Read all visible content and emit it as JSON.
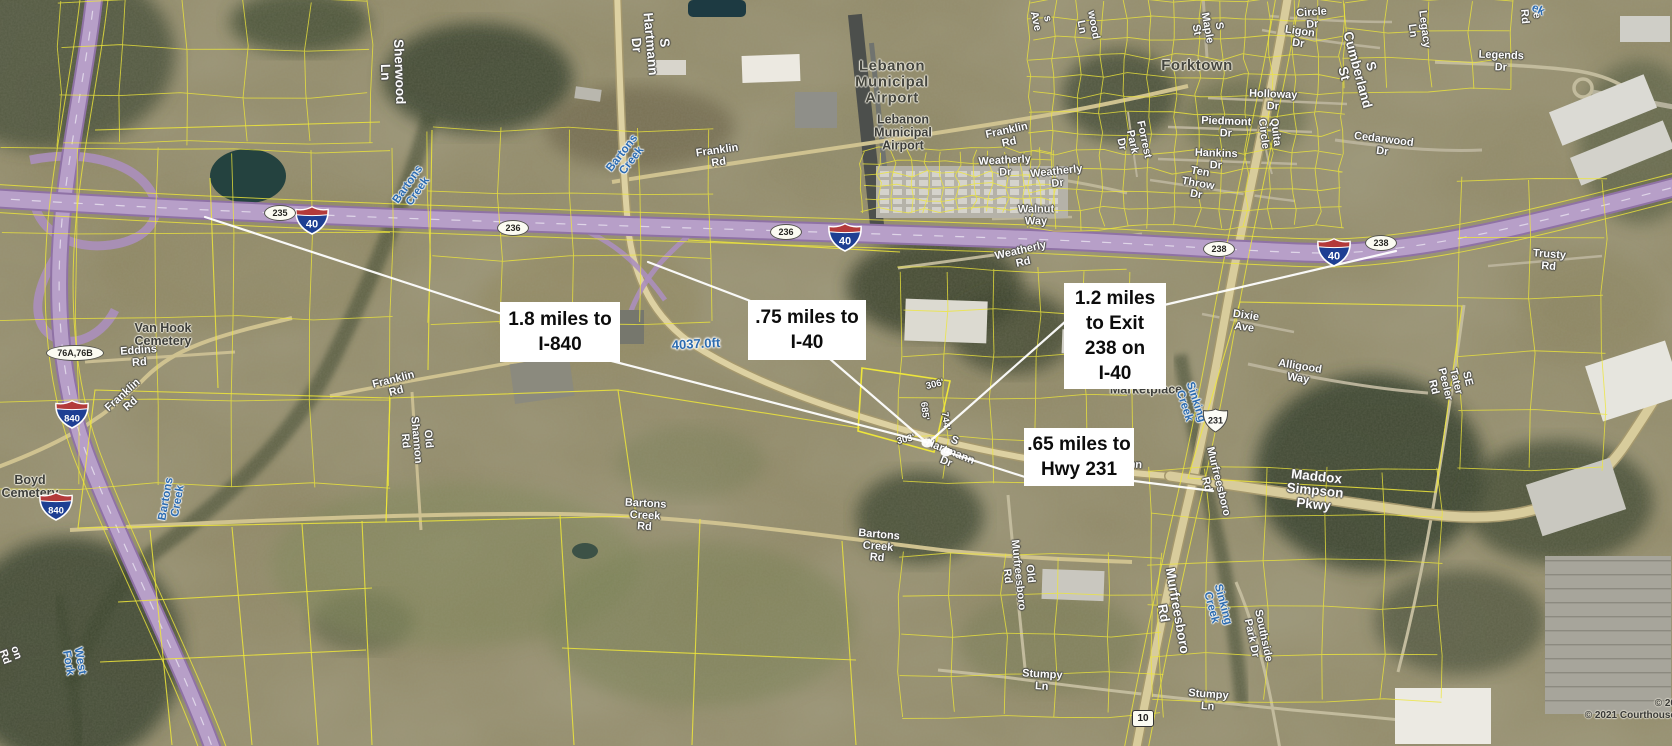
{
  "map": {
    "attribution": {
      "line1": "© 20",
      "line2": "© 2021 Courthouse"
    },
    "colors": {
      "parcel_line": "#eee63a",
      "interstate_fill": "#b79fc8",
      "road_fill": "#ddd1a2",
      "callout_bg": "#ffffff",
      "callout_text": "#0c0c0c",
      "creek_text": "#2d6cb0",
      "road_label_text": "#fdfdfd"
    },
    "callouts": [
      {
        "id": "c1",
        "lines": [
          "1.8 miles to",
          "I-840"
        ],
        "x": 500,
        "y": 302,
        "w": 120,
        "h": 60
      },
      {
        "id": "c2",
        "lines": [
          ".75 miles to",
          "I-40"
        ],
        "x": 748,
        "y": 300,
        "w": 118,
        "h": 60
      },
      {
        "id": "c3",
        "lines": [
          "1.2 miles",
          "to Exit",
          "238 on",
          "I-40"
        ],
        "x": 1064,
        "y": 283,
        "w": 102,
        "h": 106
      },
      {
        "id": "c4",
        "lines": [
          ".65 miles to",
          "Hwy 231"
        ],
        "x": 1024,
        "y": 428,
        "w": 110,
        "h": 58
      }
    ],
    "shields": [
      {
        "type": "i",
        "t": "40",
        "x": 312,
        "y": 220
      },
      {
        "type": "i",
        "t": "40",
        "x": 845,
        "y": 237
      },
      {
        "type": "i",
        "t": "40",
        "x": 1334,
        "y": 252
      },
      {
        "type": "i",
        "t": "840",
        "x": 72,
        "y": 414
      },
      {
        "type": "i",
        "t": "840",
        "x": 56,
        "y": 506
      },
      {
        "type": "mile",
        "t": "235",
        "x": 279,
        "y": 212
      },
      {
        "type": "mile",
        "t": "236",
        "x": 512,
        "y": 227
      },
      {
        "type": "mile",
        "t": "236",
        "x": 785,
        "y": 231
      },
      {
        "type": "mile",
        "t": "238",
        "x": 1218,
        "y": 248
      },
      {
        "type": "mile",
        "t": "238",
        "x": 1380,
        "y": 242
      },
      {
        "type": "exit",
        "t": "76A,76B",
        "x": 74,
        "y": 352
      },
      {
        "type": "us",
        "t": "231",
        "x": 1215,
        "y": 420
      },
      {
        "type": "sr",
        "t": "10",
        "x": 1142,
        "y": 718
      }
    ],
    "labels": [
      {
        "t": "Sherwood Ln",
        "x": 392,
        "y": 72,
        "r": 88,
        "c": "roadlg"
      },
      {
        "t": "S Hartmann Dr",
        "x": 650,
        "y": 44,
        "r": 85,
        "c": "roadlg"
      },
      {
        "t": "Franklin Rd",
        "x": 718,
        "y": 157,
        "r": -8,
        "c": "road"
      },
      {
        "t": "Lebanon Municipal Airport",
        "x": 892,
        "y": 82,
        "r": 0,
        "c": "placelg"
      },
      {
        "t": "Lebanon\nMunicipal\nAirport",
        "x": 903,
        "y": 133,
        "r": 0,
        "c": "place"
      },
      {
        "t": "Franklin Rd",
        "x": 1008,
        "y": 137,
        "r": -12,
        "c": "road"
      },
      {
        "t": "Weatherly Dr",
        "x": 1005,
        "y": 167,
        "r": -3,
        "c": "road"
      },
      {
        "t": "Weatherly Dr",
        "x": 1057,
        "y": 178,
        "r": -6,
        "c": "road"
      },
      {
        "t": "Walnut Way",
        "x": 1036,
        "y": 216,
        "r": 0,
        "c": "road"
      },
      {
        "t": "Weatherly Rd",
        "x": 1022,
        "y": 257,
        "r": -13,
        "c": "road"
      },
      {
        "t": "Forktown",
        "x": 1197,
        "y": 66,
        "r": 0,
        "c": "placelg"
      },
      {
        "t": "S Maple St",
        "x": 1207,
        "y": 28,
        "r": 80,
        "c": "road"
      },
      {
        "t": "s Ave",
        "x": 1041,
        "y": 20,
        "r": 78,
        "c": "road"
      },
      {
        "t": "wood Ln",
        "x": 1087,
        "y": 26,
        "r": 80,
        "c": "road"
      },
      {
        "t": "Circle Dr",
        "x": 1312,
        "y": 19,
        "r": -4,
        "c": "road"
      },
      {
        "t": "Ligon Dr",
        "x": 1299,
        "y": 38,
        "r": 8,
        "c": "road"
      },
      {
        "t": "Holloway Dr",
        "x": 1273,
        "y": 101,
        "r": 2,
        "c": "road"
      },
      {
        "t": "Piedmont Dr",
        "x": 1226,
        "y": 128,
        "r": 2,
        "c": "road"
      },
      {
        "t": "Quita Circle",
        "x": 1269,
        "y": 133,
        "r": 83,
        "c": "road"
      },
      {
        "t": "Hankins Dr",
        "x": 1216,
        "y": 160,
        "r": 2,
        "c": "road"
      },
      {
        "t": "Forrest Park Dr",
        "x": 1132,
        "y": 142,
        "r": 78,
        "c": "road"
      },
      {
        "t": "Ten Throw Dr",
        "x": 1198,
        "y": 184,
        "r": 10,
        "c": "road"
      },
      {
        "t": "S Cumberland St",
        "x": 1357,
        "y": 70,
        "r": 75,
        "c": "roadlg"
      },
      {
        "t": "Legacy Ln",
        "x": 1418,
        "y": 30,
        "r": 83,
        "c": "road"
      },
      {
        "t": "Legends Dr",
        "x": 1501,
        "y": 62,
        "r": 2,
        "c": "road"
      },
      {
        "t": "Cedarwood Dr",
        "x": 1383,
        "y": 146,
        "r": 7,
        "c": "road"
      },
      {
        "t": "e Rd",
        "x": 1530,
        "y": 16,
        "r": 85,
        "c": "road"
      },
      {
        "t": "ek",
        "x": 1538,
        "y": 10,
        "r": 25,
        "c": "creek"
      },
      {
        "t": "Trusty Rd",
        "x": 1549,
        "y": 261,
        "r": 4,
        "c": "road"
      },
      {
        "t": "SE Tater Peeler Rd",
        "x": 1450,
        "y": 383,
        "r": 76,
        "c": "road"
      },
      {
        "t": "Dixie Ave",
        "x": 1245,
        "y": 322,
        "r": 8,
        "c": "road"
      },
      {
        "t": "Alligood Way",
        "x": 1299,
        "y": 373,
        "r": 9,
        "c": "road"
      },
      {
        "t": "Marketplace",
        "x": 1146,
        "y": 390,
        "r": 0,
        "c": "place"
      },
      {
        "t": "Sinking Creek",
        "x": 1190,
        "y": 404,
        "r": 72,
        "c": "creek"
      },
      {
        "t": "Maddox Simpson Pkwy",
        "x": 1315,
        "y": 491,
        "r": 6,
        "c": "roadlg"
      },
      {
        "t": "Hartmann Dr",
        "x": 1116,
        "y": 470,
        "r": 4,
        "c": "road"
      },
      {
        "t": "S Hartmann Dr",
        "x": 950,
        "y": 452,
        "r": 22,
        "c": "road"
      },
      {
        "t": "Murfreesboro Rd",
        "x": 1212,
        "y": 483,
        "r": 76,
        "c": "road"
      },
      {
        "t": "Murfreesboro Rd",
        "x": 1170,
        "y": 612,
        "r": 80,
        "c": "roadlg"
      },
      {
        "t": "Old Murfreesboro Rd",
        "x": 1018,
        "y": 575,
        "r": 84,
        "c": "road"
      },
      {
        "t": "Southside Park Dr",
        "x": 1257,
        "y": 637,
        "r": 78,
        "c": "road"
      },
      {
        "t": "Sinking Creek",
        "x": 1217,
        "y": 606,
        "r": 75,
        "c": "creek"
      },
      {
        "t": "Stumpy Ln",
        "x": 1042,
        "y": 681,
        "r": 3,
        "c": "road"
      },
      {
        "t": "Stumpy Ln",
        "x": 1208,
        "y": 701,
        "r": 4,
        "c": "road"
      },
      {
        "t": "Bartons Creek Rd",
        "x": 645,
        "y": 516,
        "r": 3,
        "c": "road"
      },
      {
        "t": "Bartons Creek Rd",
        "x": 878,
        "y": 547,
        "r": 5,
        "c": "road"
      },
      {
        "t": "Franklin Rd",
        "x": 395,
        "y": 386,
        "r": -14,
        "c": "road"
      },
      {
        "t": "Old Shannon Rd",
        "x": 416,
        "y": 440,
        "r": 85,
        "c": "road"
      },
      {
        "t": "Franklin Rd",
        "x": 127,
        "y": 400,
        "r": -42,
        "c": "road"
      },
      {
        "t": "Eddins Rd",
        "x": 139,
        "y": 357,
        "r": -4,
        "c": "road"
      },
      {
        "t": "on Rd",
        "x": 10,
        "y": 655,
        "r": 70,
        "c": "road"
      },
      {
        "t": "Van Hook\nCemetery",
        "x": 163,
        "y": 335,
        "r": 0,
        "c": "place"
      },
      {
        "t": "Boyd Cemetery",
        "x": 30,
        "y": 487,
        "r": 0,
        "c": "place"
      },
      {
        "t": "West Fork",
        "x": 74,
        "y": 662,
        "r": 80,
        "c": "creek"
      },
      {
        "t": "Bartons Creek",
        "x": 172,
        "y": 500,
        "r": -80,
        "c": "creek"
      },
      {
        "t": "Bartons Creek",
        "x": 413,
        "y": 188,
        "r": -55,
        "c": "creek"
      },
      {
        "t": "Bartons Creek",
        "x": 627,
        "y": 157,
        "r": -52,
        "c": "creek"
      },
      {
        "t": "4037.0ft",
        "x": 696,
        "y": 344,
        "r": -3,
        "c": "dist"
      },
      {
        "t": "306'",
        "x": 935,
        "y": 385,
        "r": -14,
        "c": "dim"
      },
      {
        "t": "685'",
        "x": 924,
        "y": 411,
        "r": 83,
        "c": "dim"
      },
      {
        "t": "744'",
        "x": 945,
        "y": 421,
        "r": 83,
        "c": "dim"
      },
      {
        "t": "303'",
        "x": 906,
        "y": 440,
        "r": -14,
        "c": "dim"
      }
    ],
    "measure_lines": [
      {
        "x1": 205,
        "y1": 217,
        "x2": 502,
        "y2": 314
      },
      {
        "x1": 600,
        "y1": 358,
        "x2": 926,
        "y2": 442
      },
      {
        "x1": 648,
        "y1": 262,
        "x2": 753,
        "y2": 302
      },
      {
        "x1": 830,
        "y1": 359,
        "x2": 926,
        "y2": 442
      },
      {
        "x1": 928,
        "y1": 443,
        "x2": 1066,
        "y2": 321
      },
      {
        "x1": 1164,
        "y1": 305,
        "x2": 1396,
        "y2": 251
      },
      {
        "x1": 947,
        "y1": 452,
        "x2": 1028,
        "y2": 478
      },
      {
        "x1": 1134,
        "y1": 481,
        "x2": 1213,
        "y2": 491
      }
    ],
    "dots": [
      {
        "x": 927,
        "y": 443
      },
      {
        "x": 946,
        "y": 452
      }
    ]
  }
}
